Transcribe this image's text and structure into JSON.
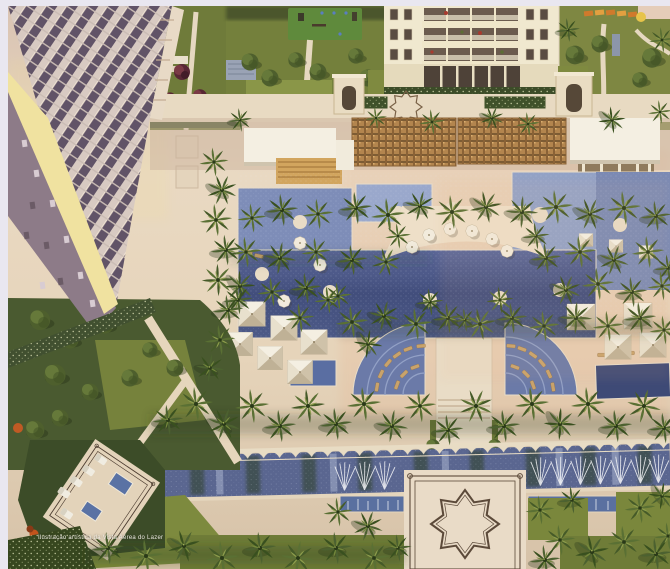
{
  "caption": "Ilustração artística da Vista Aérea do Lazer",
  "scene_type": "aerial-architectural-rendering-of-resort-leisure-area",
  "palette": {
    "frame": "#e9e7f0",
    "paving_warm": "#e7d8c2",
    "paving_pink": "#e3c6b0",
    "lawn": "#7d8a3e",
    "hedge_dark": "#3e4f2a",
    "palm_green": "#4c6130",
    "pool_light": "#9aa8cc",
    "pool_mid": "#7b8ab4",
    "pool_dark": "#46527e",
    "building_cream": "#f0e8cf",
    "tower_shadow_face": "#8d7b88",
    "tower_sunlit_edge": "#f0e2a0",
    "wood_pergola": "#b3854e",
    "white_roof": "#f4efe2",
    "ornament_line": "#5c4a3a",
    "accent_orange": "#c2541c"
  },
  "scene_elements": [
    "tower-building-top-left",
    "residential-building-top-center",
    "rooftop-gardens-top-right",
    "playground-court",
    "wood-pergolas",
    "white-pavilion-roofs",
    "main-lagoon-pool",
    "semicircular-umbrella-deck",
    "fan-shaped-lounger-pools",
    "lap-pool",
    "cabana-tents",
    "palm-tree-rows",
    "reflecting-channel-with-moorish-edge",
    "fountain-spray-basins",
    "star-pattern-plaza",
    "spa-terrace-bottom-left"
  ]
}
